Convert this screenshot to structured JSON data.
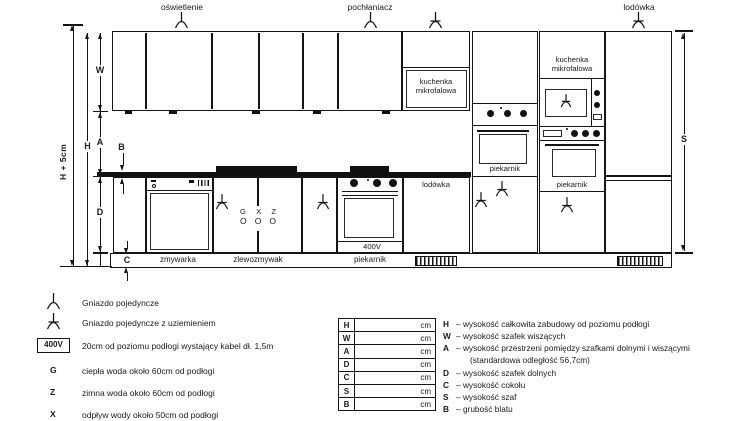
{
  "drawing": {
    "top_labels": {
      "oswietlenie": "oświetlenie",
      "pochlaniacz": "pochłaniacz",
      "lodowka": "lodówka"
    },
    "microwave_label": "kuchenka mikrofalowa",
    "oven_label": "piekarnik",
    "fridge_label": "lodówka",
    "volt_label": "400V",
    "plinth_labels": [
      "zmywarka",
      "zlewozmywak",
      "piekarnik"
    ],
    "water_points": {
      "g": "G",
      "x": "X",
      "z": "Z",
      "o": "O"
    },
    "dims": {
      "h_plus": "H + 5cm",
      "h": "H",
      "w": "W",
      "a": "A",
      "b": "B",
      "d": "D",
      "c": "C",
      "s": "S"
    }
  },
  "legend_symbols": [
    {
      "text": "Gniazdo pojedyncze"
    },
    {
      "text": "Gniazdo pojedyncze z uziemieniem"
    },
    {
      "badge": "400V",
      "text": "20cm od poziomu podłogi wystający kabel dł. 1,5m"
    },
    {
      "key": "G",
      "text": "ciepła woda około 60cm od podłogi"
    },
    {
      "key": "Z",
      "text": "zimna woda około 60cm od podłogi"
    },
    {
      "key": "X",
      "text": "odpływ wody około 50cm od podłogi"
    }
  ],
  "dim_table": {
    "rows": [
      {
        "key": "H",
        "value": "",
        "unit": "cm"
      },
      {
        "key": "W",
        "value": "",
        "unit": "cm"
      },
      {
        "key": "A",
        "value": "",
        "unit": "cm"
      },
      {
        "key": "D",
        "value": "",
        "unit": "cm"
      },
      {
        "key": "C",
        "value": "",
        "unit": "cm"
      },
      {
        "key": "S",
        "value": "",
        "unit": "cm"
      },
      {
        "key": "B",
        "value": "",
        "unit": "cm"
      }
    ]
  },
  "legend_dash": "–",
  "legend_dims": [
    {
      "key": "H",
      "text": "wysokość całkowita zabudowy od poziomu podłogi"
    },
    {
      "key": "W",
      "text": "wysokość szafek wiszących"
    },
    {
      "key": "A",
      "text": "wysokość przestrzeni pomiędzy szafkami dolnymi i wiszącymi",
      "note": "(standardowa odległość 56,7cm)"
    },
    {
      "key": "D",
      "text": "wysokość szafek dolnych"
    },
    {
      "key": "C",
      "text": "wysokość cokołu"
    },
    {
      "key": "S",
      "text": "wysokość szaf"
    },
    {
      "key": "B",
      "text": "grubość blatu"
    }
  ],
  "colors": {
    "ink": "#1a1a1a",
    "background": "#ffffff"
  }
}
